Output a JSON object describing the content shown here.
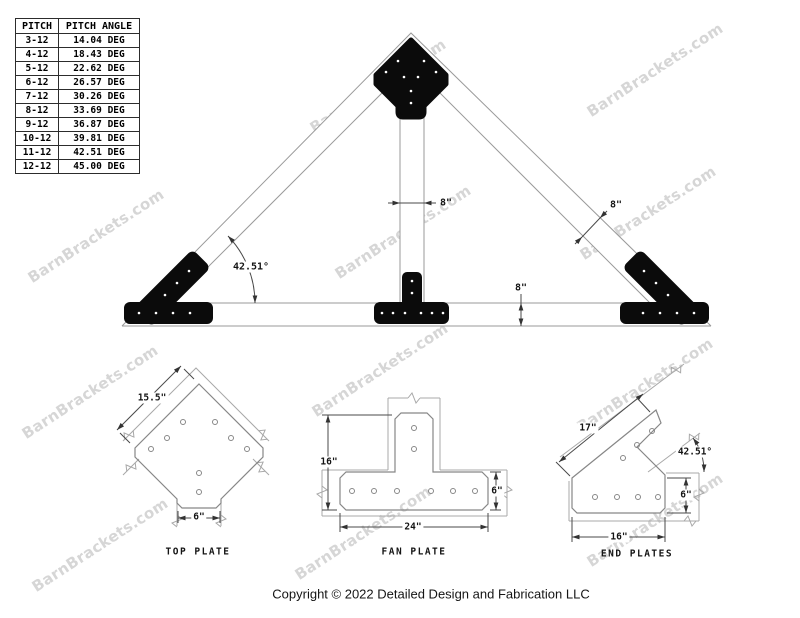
{
  "pitch_table": {
    "headers": [
      "PITCH",
      "PITCH ANGLE"
    ],
    "rows": [
      [
        "3-12",
        "14.04 DEG"
      ],
      [
        "4-12",
        "18.43 DEG"
      ],
      [
        "5-12",
        "22.62 DEG"
      ],
      [
        "6-12",
        "26.57 DEG"
      ],
      [
        "7-12",
        "30.26 DEG"
      ],
      [
        "8-12",
        "33.69 DEG"
      ],
      [
        "9-12",
        "36.87 DEG"
      ],
      [
        "10-12",
        "39.81 DEG"
      ],
      [
        "11-12",
        "42.51 DEG"
      ],
      [
        "12-12",
        "45.00 DEG"
      ]
    ]
  },
  "watermark": {
    "text": "BarnBrackets.com"
  },
  "truss_dims": {
    "angle": "42.51°",
    "king_post_width": "8\"",
    "rafter_width": "8\"",
    "chord_height": "8\""
  },
  "top_plate": {
    "title": "TOP PLATE",
    "edge_dim": "15.5\"",
    "stem_dim": "6\""
  },
  "fan_plate": {
    "title": "FAN PLATE",
    "height_dim": "16\"",
    "width_dim": "24\"",
    "bar_dim": "6\""
  },
  "end_plates": {
    "title": "END PLATES",
    "arm_dim": "17\"",
    "base_dim": "16\"",
    "bar_dim": "6\"",
    "angle_dim": "42.51°"
  },
  "footer": {
    "copyright": "Copyright © 2022 Detailed Design and Fabrication LLC"
  }
}
